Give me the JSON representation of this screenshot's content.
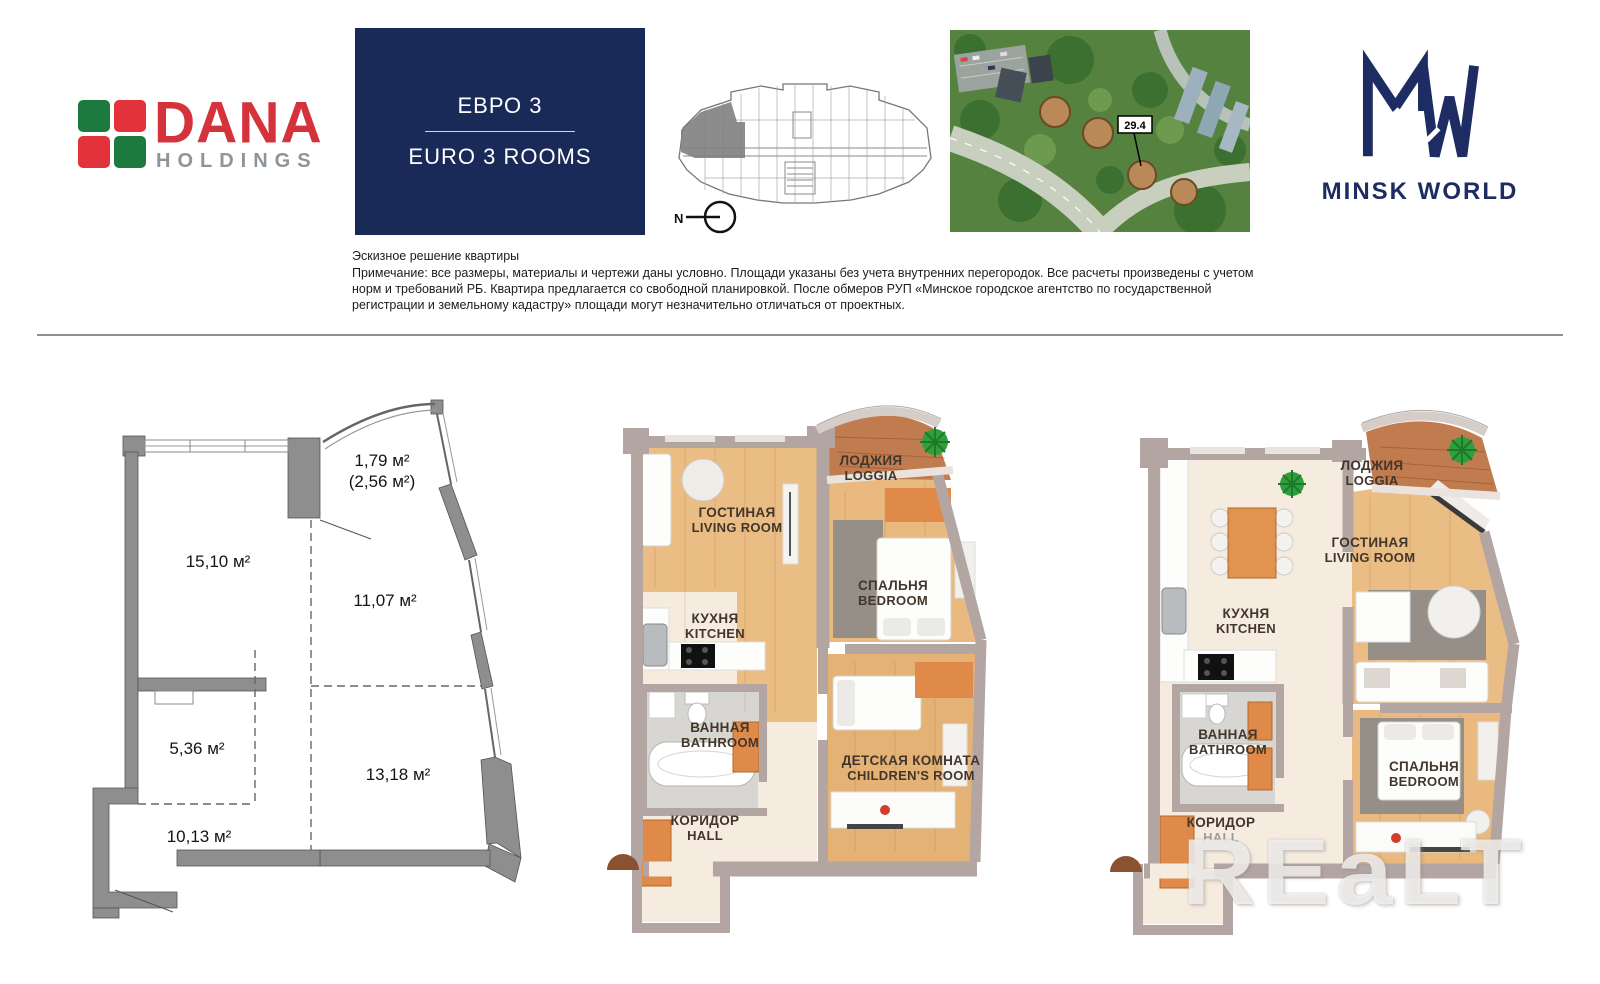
{
  "header": {
    "dana_logo": {
      "name": "DANA",
      "subtitle": "HOLDINGS"
    },
    "apartment_type": {
      "ru": "ЕВРО 3",
      "en": "EURO 3 ROOMS"
    },
    "compass": {
      "north_label": "N"
    },
    "site_map": {
      "building_label": "29.4"
    },
    "minsk_world_logo": {
      "name": "MINSK WORLD"
    }
  },
  "disclaimer": {
    "title": "Эскизное решение квартиры",
    "body": "Примечание: все размеры, материалы и чертежи даны условно. Площади указаны без учета внутренних перегородок. Все расчеты произведены с учетом норм и требований РБ. Квартира предлагается со свободной планировкой. После обмеров РУП «Минское городское агентство по государственной регистрации и земельному кадастру» площади могут незначительно отличаться от проектных."
  },
  "floor_plan_2d": {
    "areas": [
      {
        "label": "1,79 м²"
      },
      {
        "label": "(2,56 м²)"
      },
      {
        "label": "15,10 м²"
      },
      {
        "label": "11,07 м²"
      },
      {
        "label": "5,36 м²"
      },
      {
        "label": "13,18 м²"
      },
      {
        "label": "10,13 м²"
      }
    ]
  },
  "floor_plan_3d_a": {
    "rooms": [
      {
        "ru": "ЛОДЖИЯ",
        "en": "LOGGIA"
      },
      {
        "ru": "ГОСТИНАЯ",
        "en": "LIVING ROOM"
      },
      {
        "ru": "КУХНЯ",
        "en": "KITCHEN"
      },
      {
        "ru": "СПАЛЬНЯ",
        "en": "BEDROOM"
      },
      {
        "ru": "ВАННАЯ",
        "en": "BATHROOM"
      },
      {
        "ru": "КОРИДОР",
        "en": "HALL"
      },
      {
        "ru": "ДЕТСКАЯ КОМНАТА",
        "en": "CHILDREN'S ROOM"
      }
    ]
  },
  "floor_plan_3d_b": {
    "rooms": [
      {
        "ru": "ЛОДЖИЯ",
        "en": "LOGGIA"
      },
      {
        "ru": "ГОСТИНАЯ",
        "en": "LIVING ROOM"
      },
      {
        "ru": "КУХНЯ",
        "en": "KITCHEN"
      },
      {
        "ru": "ВАННАЯ",
        "en": "BATHROOM"
      },
      {
        "ru": "КОРИДОР",
        "en": "HALL"
      },
      {
        "ru": "СПАЛЬНЯ",
        "en": "BEDROOM"
      }
    ]
  },
  "watermark": "REaLT",
  "colors": {
    "navy_box": "#1a2a58",
    "dana_red": "#d4333b",
    "dana_green": "#1c7a3e",
    "mw_navy": "#1d2c62",
    "wall_mauve": "#b3a5a1",
    "wood_floor": "#eabd85",
    "loggia_wood": "#c07c4e",
    "plan_wall_gray": "#8e8e8e"
  }
}
